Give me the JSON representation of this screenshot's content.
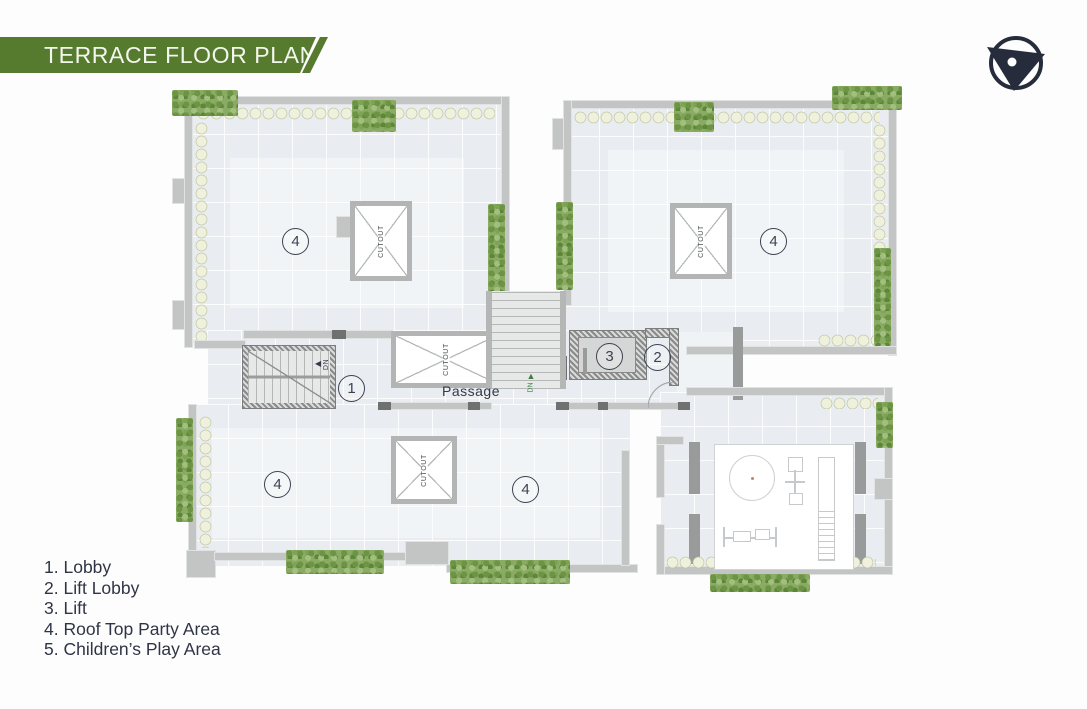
{
  "header": {
    "title": "TERRACE FLOOR PLAN"
  },
  "icons": {
    "compass": "north-arrow"
  },
  "legend": {
    "items": [
      {
        "num": "1.",
        "label": "Lobby"
      },
      {
        "num": "2.",
        "label": "Lift Lobby"
      },
      {
        "num": "3.",
        "label": "Lift"
      },
      {
        "num": "4.",
        "label": "Roof Top Party Area"
      },
      {
        "num": "5.",
        "label": "Children’s Play Area"
      }
    ]
  },
  "plan": {
    "markers": {
      "lobby": "1",
      "lift_lobby": "2",
      "lift": "3",
      "party_area": "4",
      "play_area": "5"
    },
    "passage_label": "Passage",
    "cutout_label": "CUTOUT",
    "down_label": "DN"
  },
  "colors": {
    "accent_green": "#567a2e",
    "ink": "#333a49",
    "wall_gray": "#c2c5c4",
    "floor_blue": "#e9edf1",
    "hedge_cream": "#eff1dc",
    "shrub_green": "#86a95e"
  }
}
